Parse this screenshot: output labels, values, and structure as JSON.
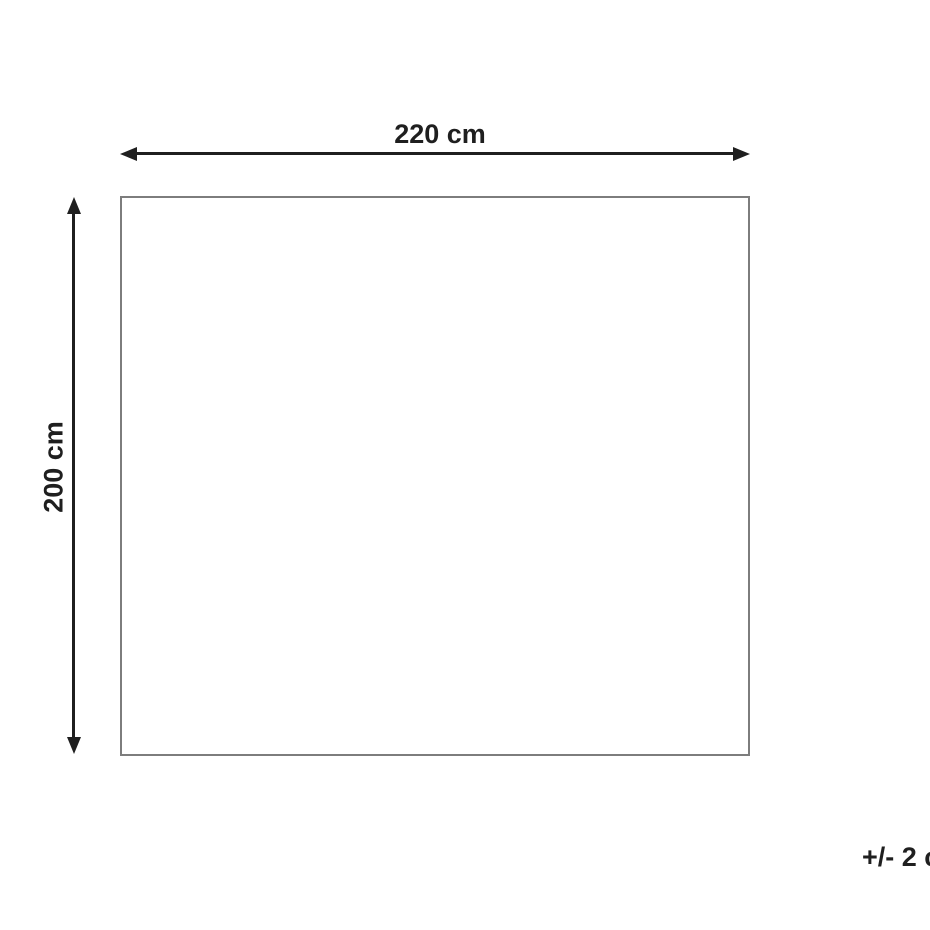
{
  "diagram": {
    "type": "product-dimension-diagram",
    "shape": "rectangle",
    "width": {
      "label": "220 cm"
    },
    "height": {
      "label": "200 cm"
    },
    "tolerance": {
      "label": "+/- 2 cm"
    }
  },
  "colors": {
    "background": "#ffffff",
    "arrow": "#1f1f1f",
    "label_text": "#1f1f1f",
    "rect_border": "#7d7d7d"
  }
}
